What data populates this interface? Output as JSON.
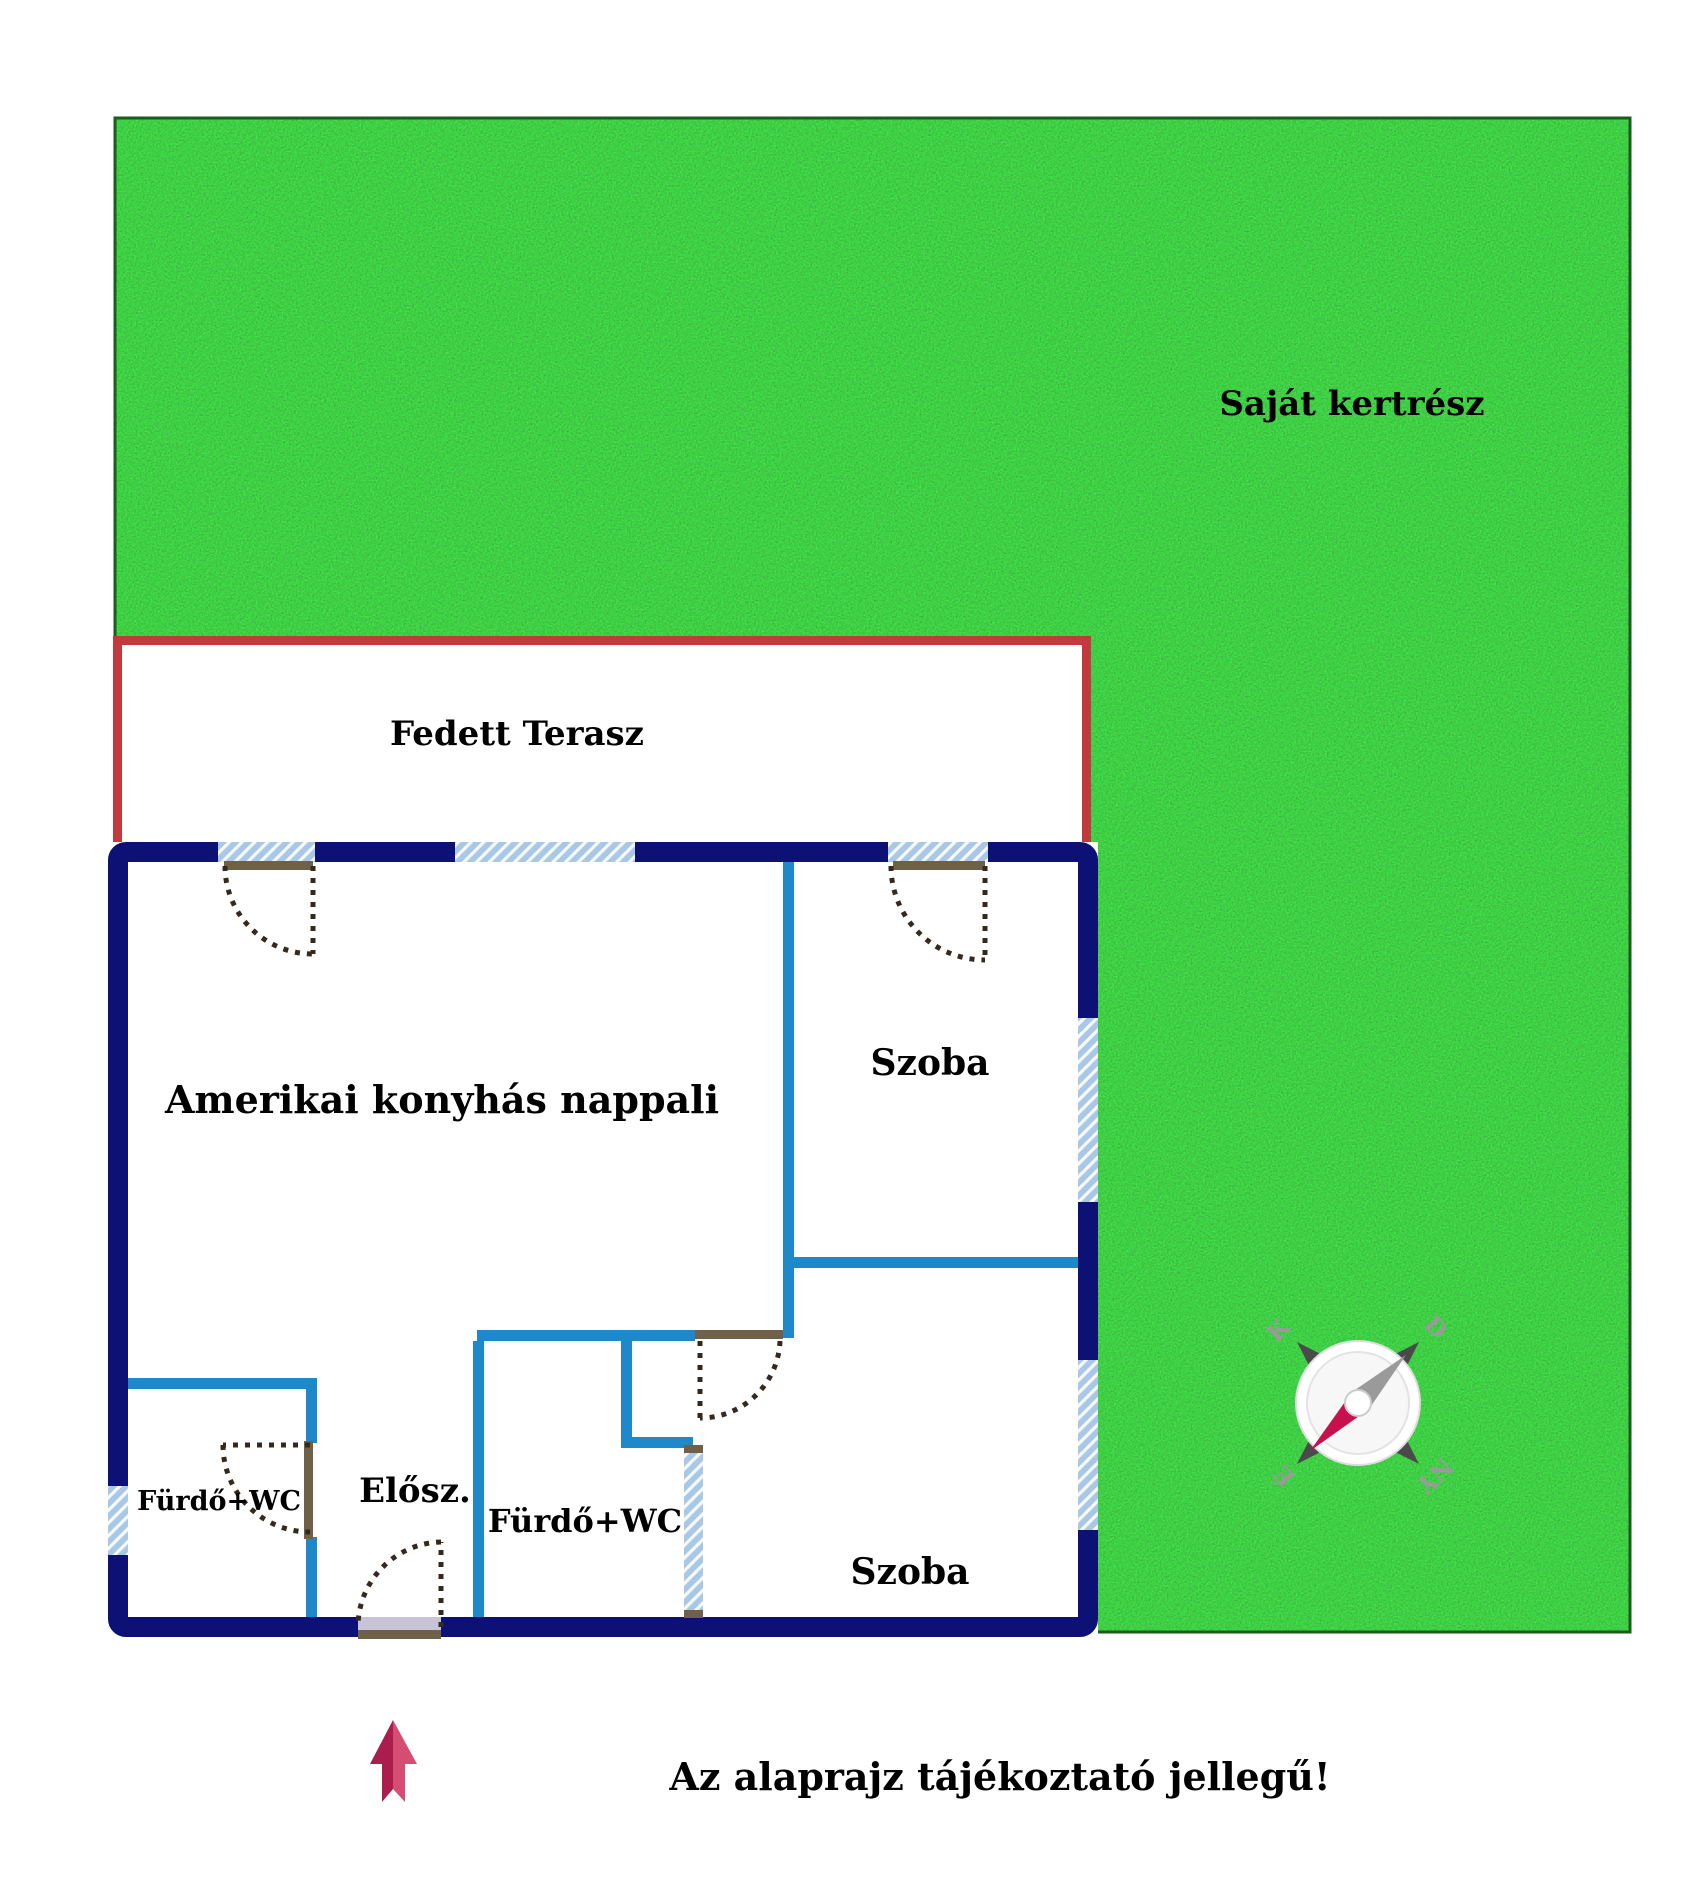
{
  "page": {
    "width": 1700,
    "height": 1880,
    "background": "#ffffff"
  },
  "garden": {
    "label": "Saját kertrész",
    "grass_color": "#2e8b2e"
  },
  "terrace": {
    "label": "Fedett Terasz",
    "border_color": "#c23a3e"
  },
  "floorplan": {
    "living_room": "Amerikai konyhás nappali",
    "room_top_right": "Szoba",
    "room_bottom_right": "Szoba",
    "bathroom_left": "Fürdő+WC",
    "bathroom_middle": "Fürdő+WC",
    "hallway": "Elősz.",
    "wall_color": "#0d1175",
    "partition_color": "#1e88c8",
    "window_color": "#a9c8e6",
    "lintel_color": "#6e6148"
  },
  "compass": {
    "north": "É",
    "south": "D",
    "east": "K",
    "west": "NY",
    "needle_color": "#c8104c"
  },
  "footer": {
    "note": "Az alaprajz tájékoztató jellegű!",
    "arrow_color_dark": "#ab1d4d",
    "arrow_color_light": "#d64d74"
  }
}
